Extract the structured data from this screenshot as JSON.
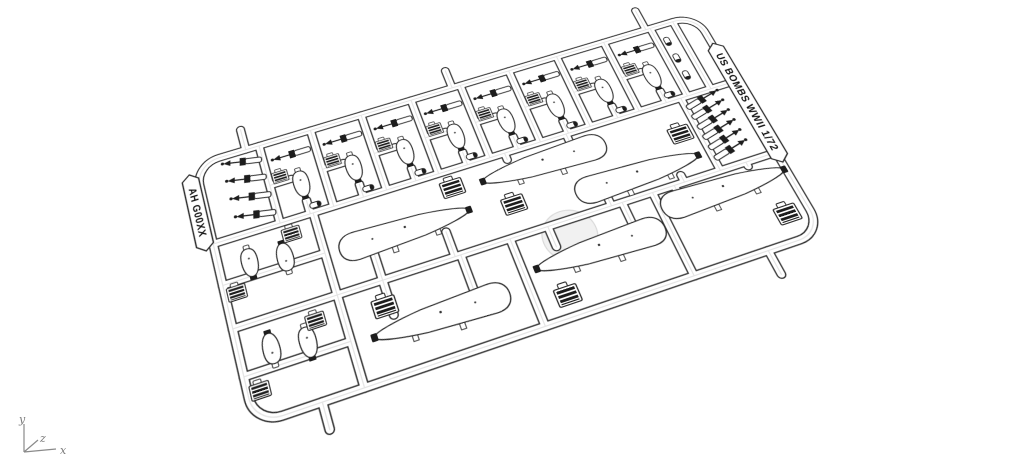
{
  "sprue": {
    "label_top_right": "US BOMBS WWII 1/72",
    "label_left": "AH G00XX",
    "plastic_color": "#ffffff",
    "outline_color": "#2b2b2b",
    "dark_part_color": "#1d1d1d",
    "faint_circle_color": "#f1f1f1"
  },
  "axis_triad": {
    "labels": {
      "x": "x",
      "y": "y",
      "z": "z"
    },
    "color": "#8a8a8a"
  },
  "parts": {
    "top_row_cells": 8,
    "cell_darts": 8,
    "left_column_darts": 4,
    "right_column_darts": 6,
    "cell_medium_bombs": 8,
    "paired_medium_bombs": 4,
    "large_bombs": 6,
    "large_fin_boxes": 6,
    "pair_fin_boxes": 4,
    "small_nose_parts": 3
  }
}
